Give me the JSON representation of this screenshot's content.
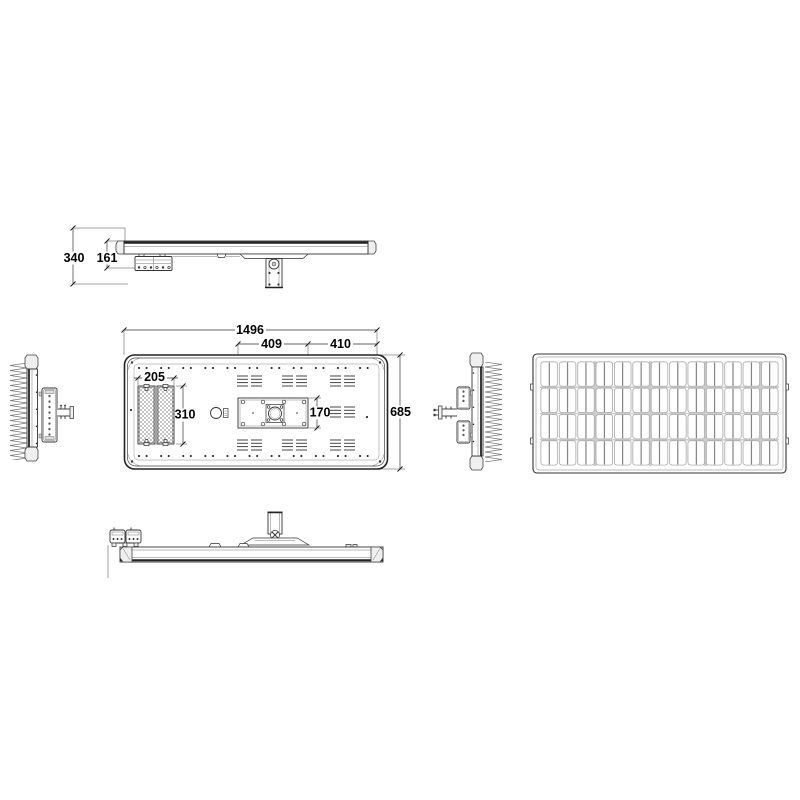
{
  "dims": {
    "side": {
      "total_height": "340",
      "lamp_drop": "161"
    },
    "plan": {
      "overall_length": "1496",
      "bracket_inset": "409",
      "bracket_to_edge": "410",
      "led_module_width": "205",
      "led_module_length": "310",
      "bracket_plate_width": "170",
      "overall_width": "685"
    }
  }
}
